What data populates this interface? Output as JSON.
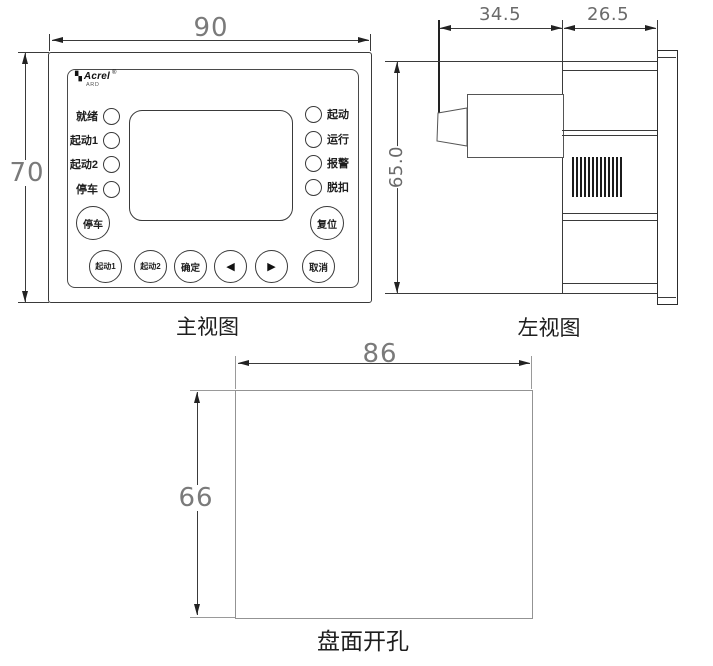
{
  "front_view": {
    "caption": "主视图",
    "brand": {
      "icon": "▚",
      "name": "Acrel",
      "reg": "®",
      "sub": "ARD"
    },
    "dims": {
      "width": "90",
      "height": "70"
    },
    "leds_left": [
      {
        "label": "就绪"
      },
      {
        "label": "起动1"
      },
      {
        "label": "起动2"
      },
      {
        "label": "停车"
      }
    ],
    "leds_right": [
      {
        "label": "起动"
      },
      {
        "label": "运行"
      },
      {
        "label": "报警"
      },
      {
        "label": "脱扣"
      }
    ],
    "buttons": {
      "stop": "停车",
      "reset": "复位",
      "row": [
        {
          "label": "起动1"
        },
        {
          "label": "起动2"
        },
        {
          "label": "确定"
        },
        {
          "label": "◀"
        },
        {
          "label": "▶"
        },
        {
          "label": "取消"
        }
      ]
    }
  },
  "side_view": {
    "caption": "左视图",
    "dims": {
      "rear_depth": "34.5",
      "front_depth": "26.5",
      "height": "65.0"
    }
  },
  "cutout_view": {
    "caption": "盘面开孔",
    "dims": {
      "width": "86",
      "height": "66"
    }
  },
  "colors": {
    "line": "#3a3a3a",
    "dim_text": "#7a7a7a",
    "background": "#ffffff"
  }
}
